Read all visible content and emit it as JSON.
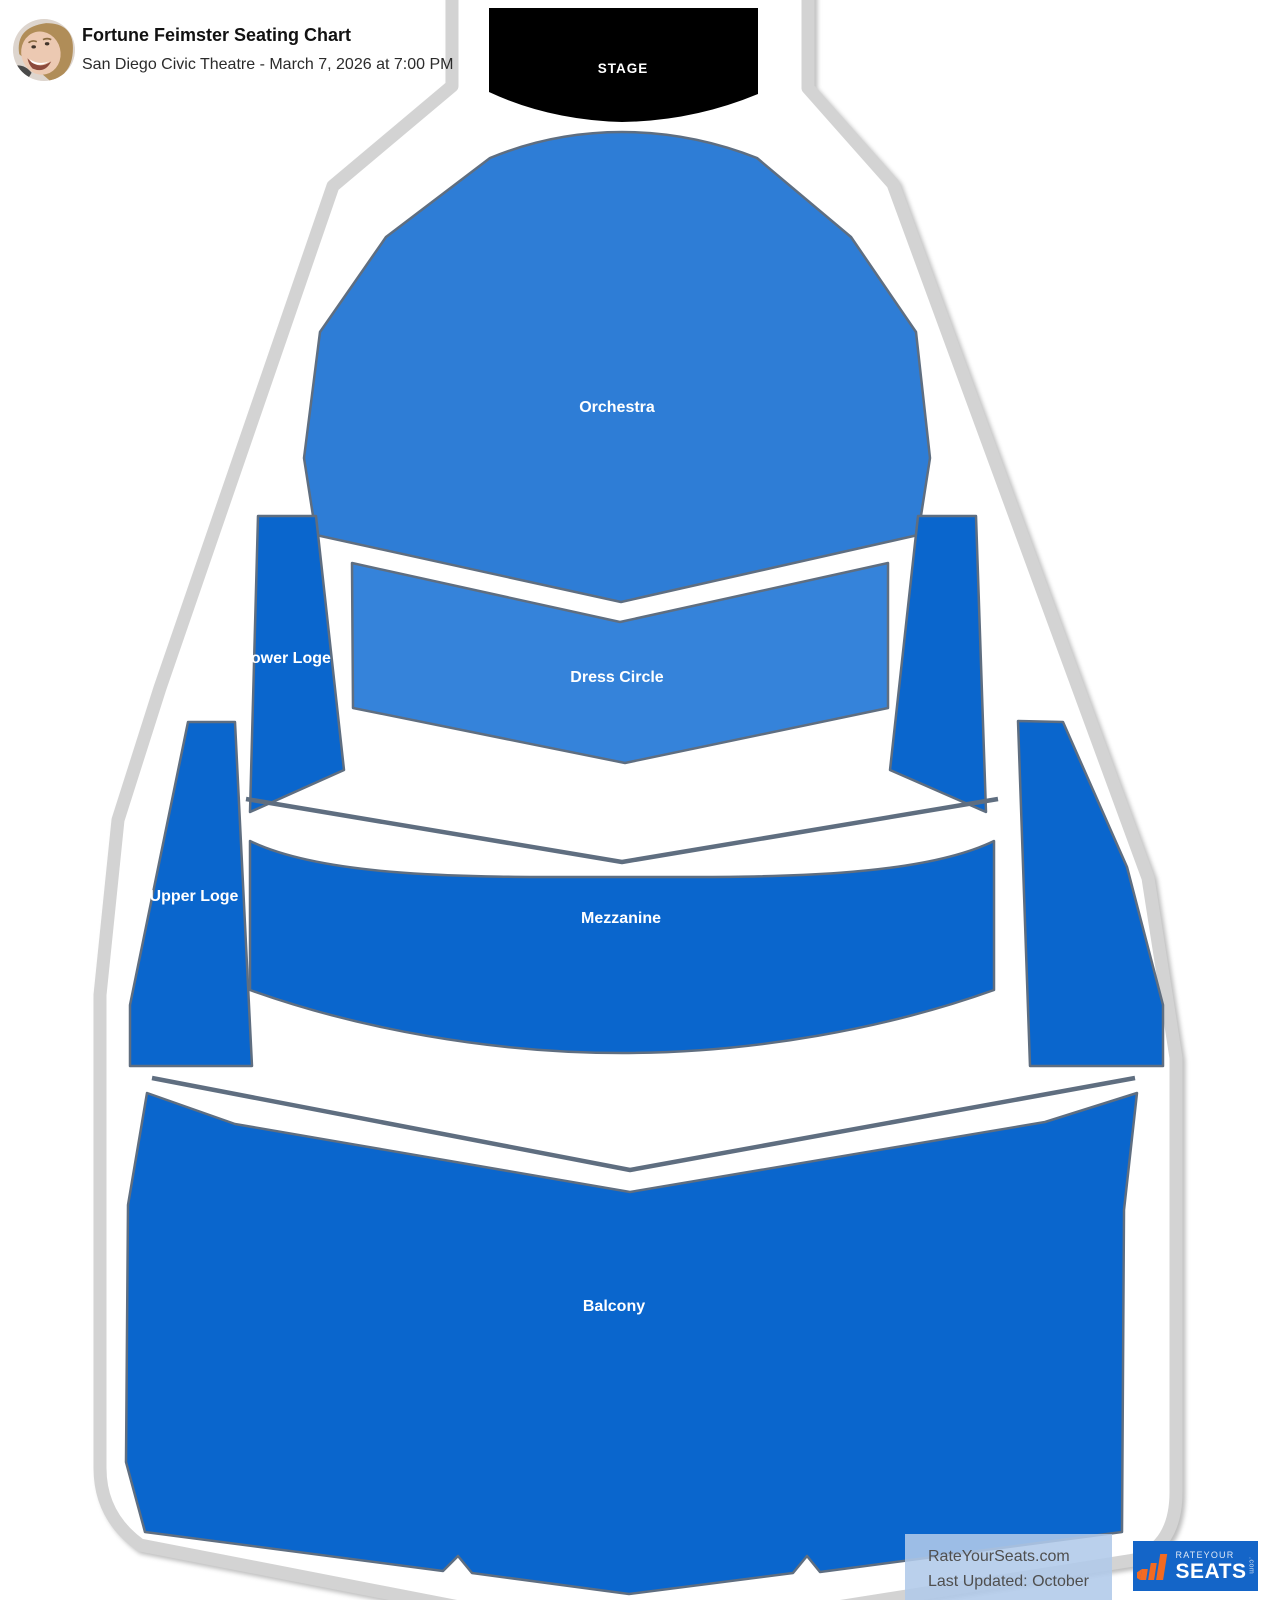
{
  "header": {
    "title": "Fortune Feimster Seating Chart",
    "subtitle": "San Diego Civic Theatre - March 7, 2026 at 7:00 PM",
    "avatar": "fortune-feimster-photo"
  },
  "stage": {
    "label": "STAGE",
    "color": "#000000"
  },
  "sections": [
    {
      "name": "Orchestra",
      "color": "#2e7dd6"
    },
    {
      "name": "Dress Circle",
      "color": "#3583da"
    },
    {
      "name": "Lower Loge",
      "color": "#0a66cd"
    },
    {
      "name": "Upper Loge",
      "color": "#0a66cd"
    },
    {
      "name": "Mezzanine",
      "color": "#0a66cd"
    },
    {
      "name": "Balcony",
      "color": "#0a66cd"
    }
  ],
  "colors": {
    "section_stroke": "#5f6e80",
    "wall_outline": "#d3d3d3",
    "wall_fill": "#ffffff",
    "watermark_bg": "#b0c9e9",
    "watermark_text": "#4f4f4f",
    "logo_background": "#1465c8",
    "logo_accent": "#f26a21"
  },
  "footer": {
    "watermark_line1": "RateYourSeats.com",
    "watermark_line2": "Last Updated: October 21, 2025",
    "logo": {
      "line1": "RATEYOUR",
      "line2": "SEATS",
      "suffix": ".com"
    }
  }
}
